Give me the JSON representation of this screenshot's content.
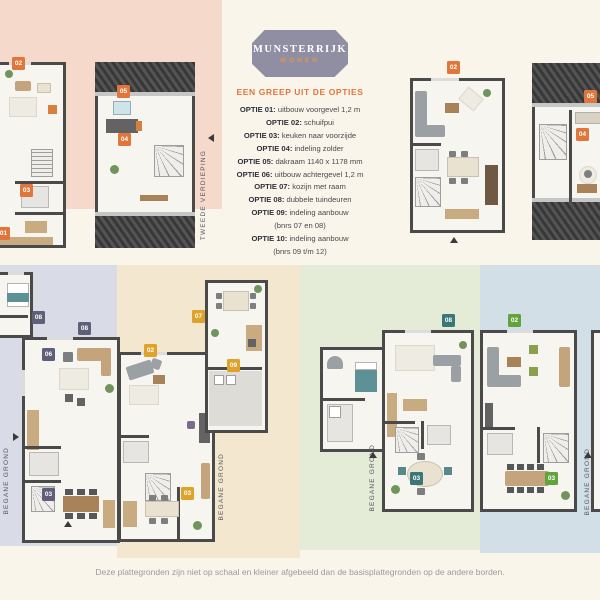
{
  "logo": {
    "title": "MUNSTERRIJK",
    "subtitle": "WONEN"
  },
  "options": {
    "heading": "EEN GREEP UIT DE OPTIES",
    "items": [
      {
        "label": "OPTIE 01:",
        "text": "uitbouw voorgevel 1,2 m"
      },
      {
        "label": "OPTIE 02:",
        "text": "schuifpui"
      },
      {
        "label": "OPTIE 03:",
        "text": "keuken naar voorzijde"
      },
      {
        "label": "OPTIE 04:",
        "text": "indeling zolder"
      },
      {
        "label": "OPTIE 05:",
        "text": "dakraam 1140 x 1178 mm"
      },
      {
        "label": "OPTIE 06:",
        "text": "uitbouw achtergevel 1,2 m"
      },
      {
        "label": "OPTIE 07:",
        "text": "kozijn met raam"
      },
      {
        "label": "OPTIE 08:",
        "text": "dubbele tuindeuren"
      },
      {
        "label": "OPTIE 09:",
        "text": "indeling aanbouw",
        "note": "(bnrs 07 en 08)"
      },
      {
        "label": "OPTIE 10:",
        "text": "indeling aanbouw",
        "note": "(bnrs 09 t/m 12)"
      }
    ]
  },
  "labels": {
    "tweede_verdieping": "TWEEDE VERDIEPING",
    "begane_grond": "BEGANE GROND"
  },
  "plans": {
    "tl_left": {
      "badges": [
        "02",
        "03",
        "01"
      ]
    },
    "tl_attic": {
      "badges": [
        "05",
        "04"
      ]
    },
    "tr_main": {
      "badges": [
        "02"
      ]
    },
    "tr_attic": {
      "badges": [
        "05",
        "04"
      ]
    },
    "lavender": {
      "badges": [
        "08",
        "08",
        "06",
        "03"
      ]
    },
    "cream": {
      "badges": [
        "07",
        "02",
        "09",
        "03"
      ]
    },
    "green": {
      "badges": [
        "08",
        "03"
      ]
    },
    "blue": {
      "badges": [
        "02",
        "03"
      ]
    }
  },
  "footer": {
    "caption": "Deze plattegronden zijn niet op schaal en kleiner afgebeeld dan de basisplattegronden op de andere borden."
  },
  "colors": {
    "page_bg": "#FAF5EB",
    "accent_orange": "#E0763C",
    "badge_slate": "#5F5F78",
    "badge_gold": "#DFA32B",
    "badge_teal": "#3A7878",
    "badge_green": "#62A33C",
    "block_pink": "#F5D9CB",
    "block_lavender": "#D9DBE6",
    "block_tan": "#F3E8CF",
    "block_sage": "#E4EBD7",
    "block_blue": "#D3DFE6",
    "logo_bg": "#8F8EA3",
    "wall": "#4A4A4A"
  }
}
